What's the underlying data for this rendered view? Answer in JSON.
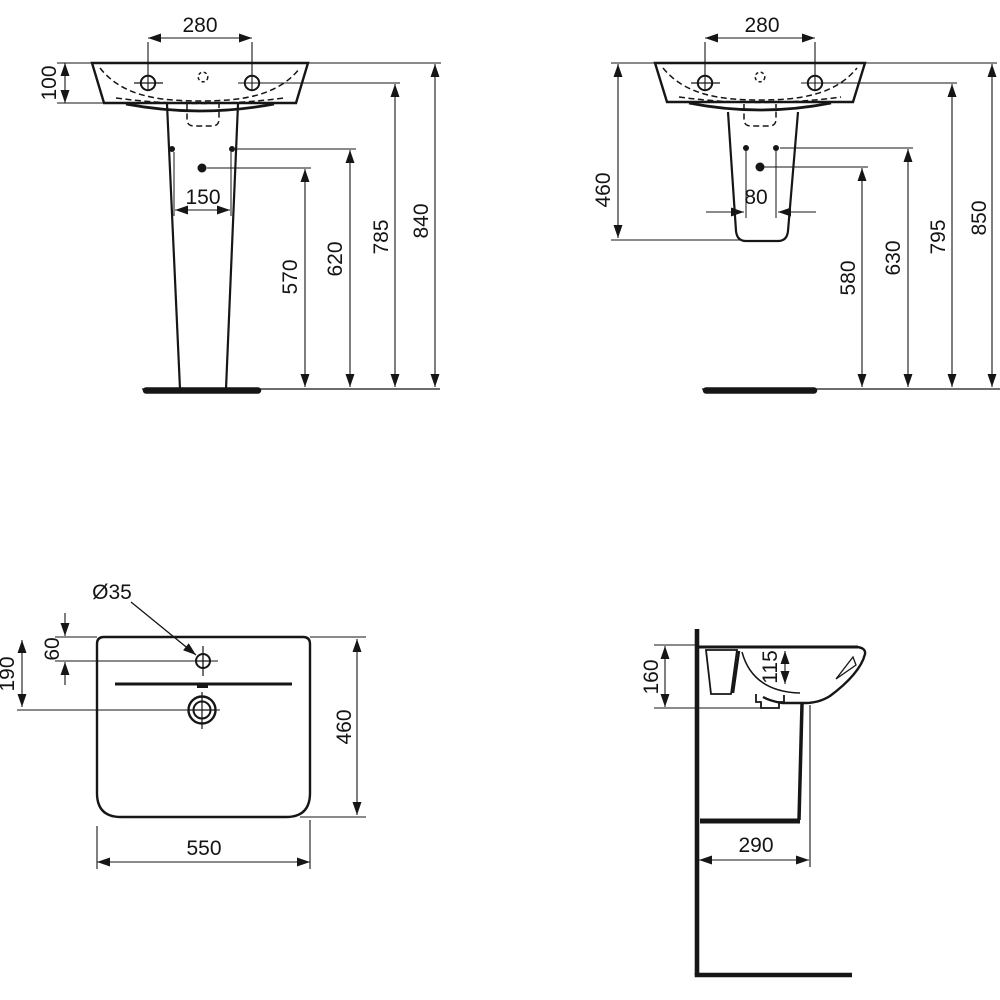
{
  "drawing": {
    "front_full": {
      "tap_spacing": "280",
      "basin_height": "100",
      "fixing_spacing": "150",
      "drain_height": "570",
      "fixing_height": "620",
      "deck_height": "785",
      "rim_height": "840"
    },
    "front_semi": {
      "tap_spacing": "280",
      "unit_height": "460",
      "fixing_spacing": "80",
      "drain_height": "580",
      "fixing_height": "630",
      "deck_height": "795",
      "rim_height": "850"
    },
    "plan": {
      "tap_hole_diameter": "Ø35",
      "tap_hole_offset": "60",
      "drain_offset": "190",
      "depth": "460",
      "width": "550"
    },
    "side": {
      "front_height": "160",
      "bowl_depth": "115",
      "projection": "290"
    }
  }
}
